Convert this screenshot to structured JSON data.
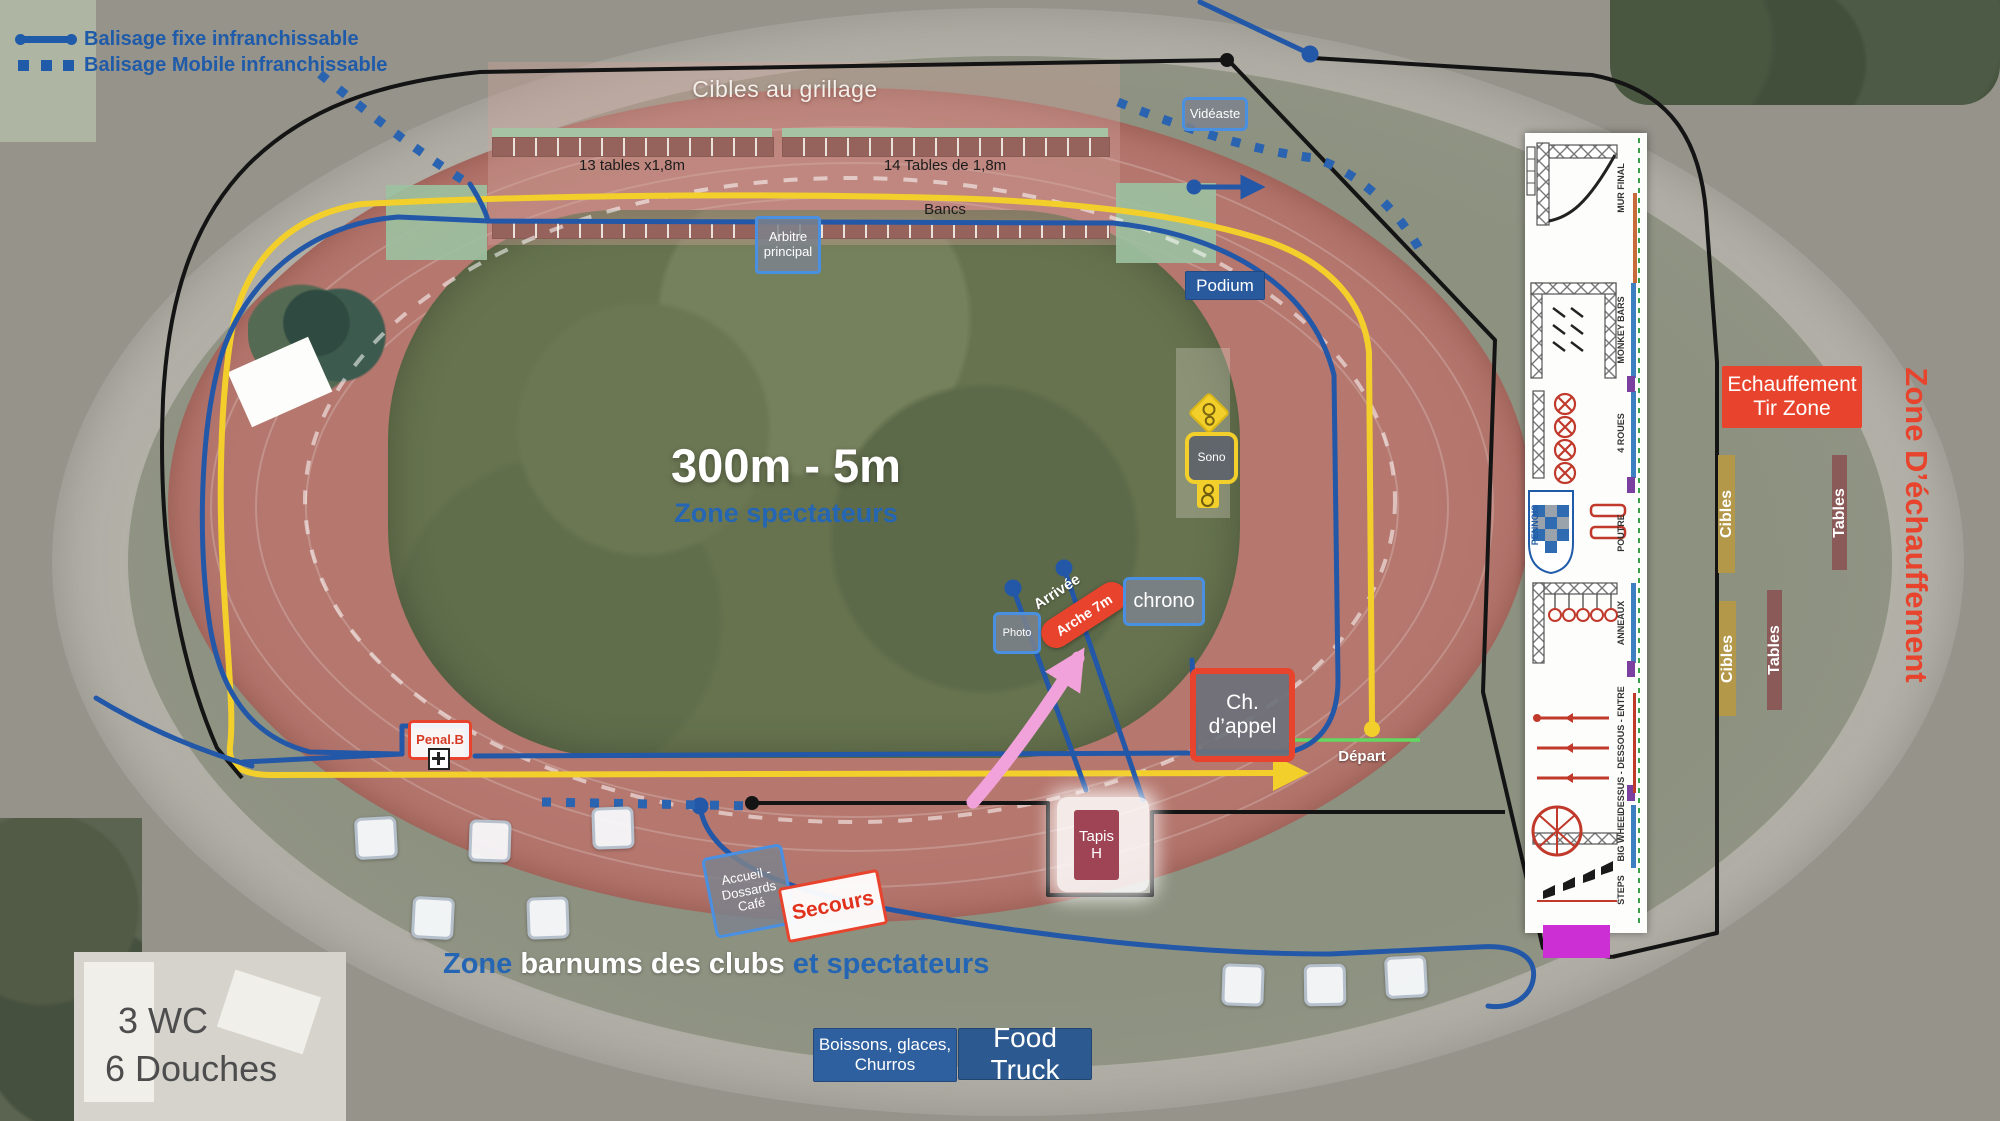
{
  "colors": {
    "legend_blue": "#1f5ba8",
    "line_blue": "#2357a7",
    "label_border_blue": "#4a90e2",
    "navy_box": "#2a5a9e",
    "red": "#e8432c",
    "dark_red_box": "#9e4455",
    "yellow_line": "#f3cf2b",
    "olive_strip": "#b3984a",
    "brown_strip": "#8a5a58",
    "table_brown": "#96625c",
    "green_strip": "#a6c4a4",
    "sage_rect": "#9cc0a0",
    "magenta": "#cc2fd4",
    "pink_arrow": "#f2a2da",
    "green_line": "#62d960",
    "black_line": "#141414"
  },
  "legend": {
    "fixed_label": "Balisage fixe infranchissable",
    "mobile_label": "Balisage Mobile infranchissable"
  },
  "shooting_zone": {
    "title": "Cibles au grillage",
    "left_tables_label": "13 tables x1,8m",
    "right_tables_label": "14 Tables de 1,8m",
    "benches_label": "Bancs"
  },
  "infield": {
    "course_label": "300m - 5m",
    "spectators_label": "Zone spectateurs"
  },
  "markers": {
    "videaste": "Vidéaste",
    "arbitre_line1": "Arbitre",
    "arbitre_line2": "principal",
    "podium": "Podium",
    "sono": "Sono",
    "photo": "Photo",
    "arrivee": "Arrivée",
    "arche": "Arche 7m",
    "chrono": "chrono",
    "call_room_line1": "Ch.",
    "call_room_line2": "d’appel",
    "depart": "Départ",
    "penal": "Penal.B",
    "tapis_line1": "Tapis",
    "tapis_line2": "H",
    "accueil_line1": "Accueil -",
    "accueil_line2": "Dossards",
    "accueil_line3": "Café",
    "secours": "Secours"
  },
  "bottom": {
    "barnums_part1": "Zone",
    "barnums_part2": "barnums des clubs",
    "barnums_part3": "et spectateurs",
    "wc": "3 WC",
    "douches": "6 Douches",
    "boissons_line1": "Boissons, glaces,",
    "boissons_line2": "Churros",
    "food_truck": "Food Truck"
  },
  "warmup": {
    "tir_line1": "Echauffement",
    "tir_line2": "Tir Zone",
    "zone_title": "Zone D’échauffement",
    "cibles": "Cibles",
    "tables": "Tables"
  },
  "panel": {
    "logo": "PENNOIS",
    "stations": [
      "MUR FINAL",
      "MONKEY BARS",
      "4 ROUES",
      "POUTRE",
      "ANNEAUX",
      "DESSUS - DESSOUS - ENTRE",
      "BIG WHEEL",
      "STEPS"
    ]
  }
}
